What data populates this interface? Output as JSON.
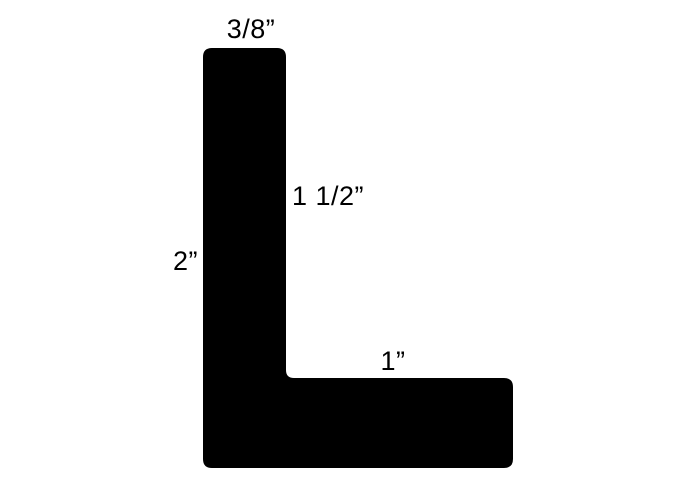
{
  "figure": {
    "shape_color": "#000000",
    "background_color": "#ffffff",
    "text_color": "#000000",
    "dimensions": {
      "top_width": "3/8”",
      "inner_leg_height": "1 1/2”",
      "overall_height": "2”",
      "bottom_leg_width": "1”"
    }
  }
}
